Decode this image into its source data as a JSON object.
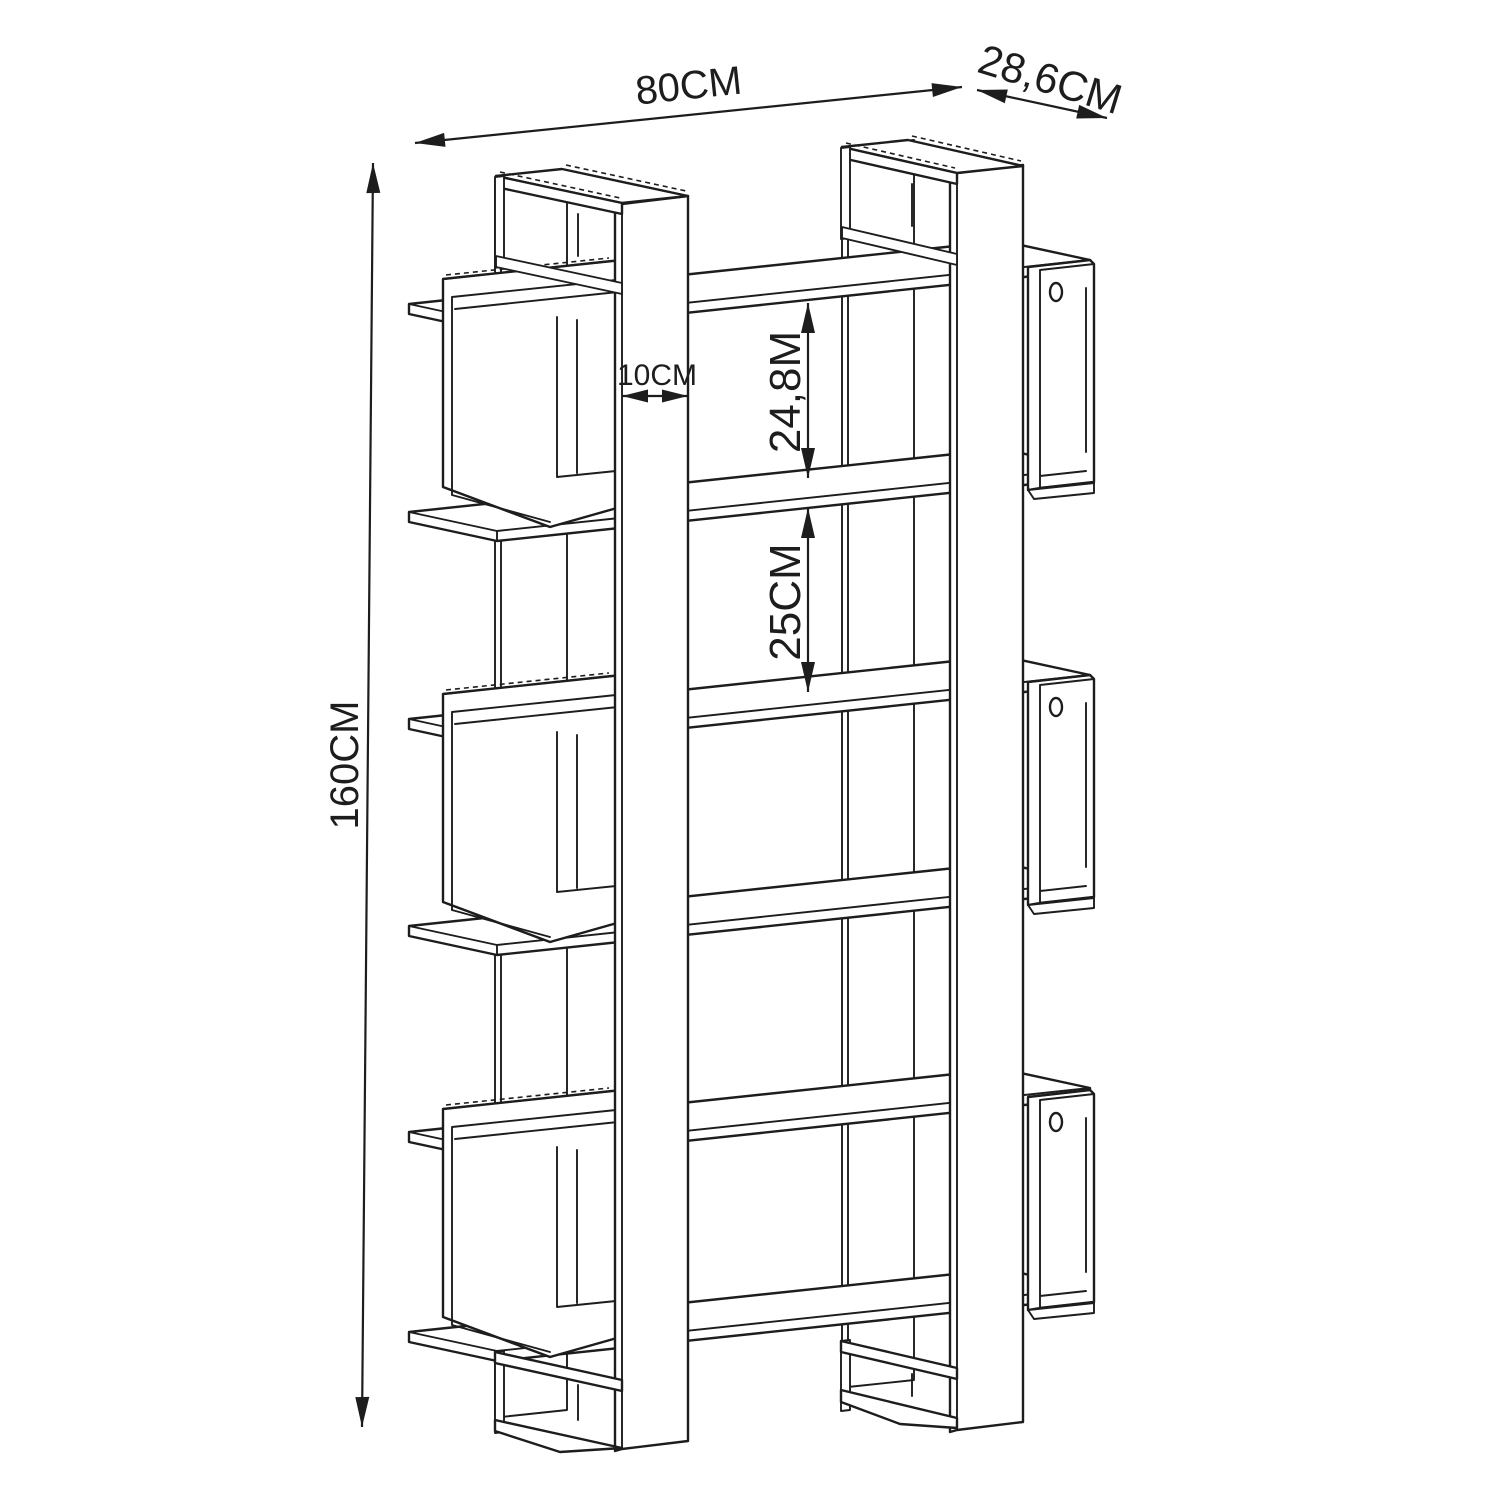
{
  "page": {
    "background": "#ffffff",
    "line_color": "#1d1d1d"
  },
  "drawing": {
    "type": "furniture-dimension-diagram",
    "subject": "open bookshelf with two uprights, six shelves and side cubbies",
    "dimensions": {
      "width": {
        "label": "80CM"
      },
      "depth": {
        "label": "28,6CM"
      },
      "height": {
        "label": "160CM"
      },
      "upright": {
        "label": "10CM"
      },
      "gap_upper": {
        "label": "24,8M"
      },
      "gap_lower": {
        "label": "25CM"
      }
    },
    "structure": {
      "uprights": 2,
      "shelves": 6,
      "left_cubbies": 3,
      "right_cubbies": 3,
      "screw_holes": 3
    }
  }
}
